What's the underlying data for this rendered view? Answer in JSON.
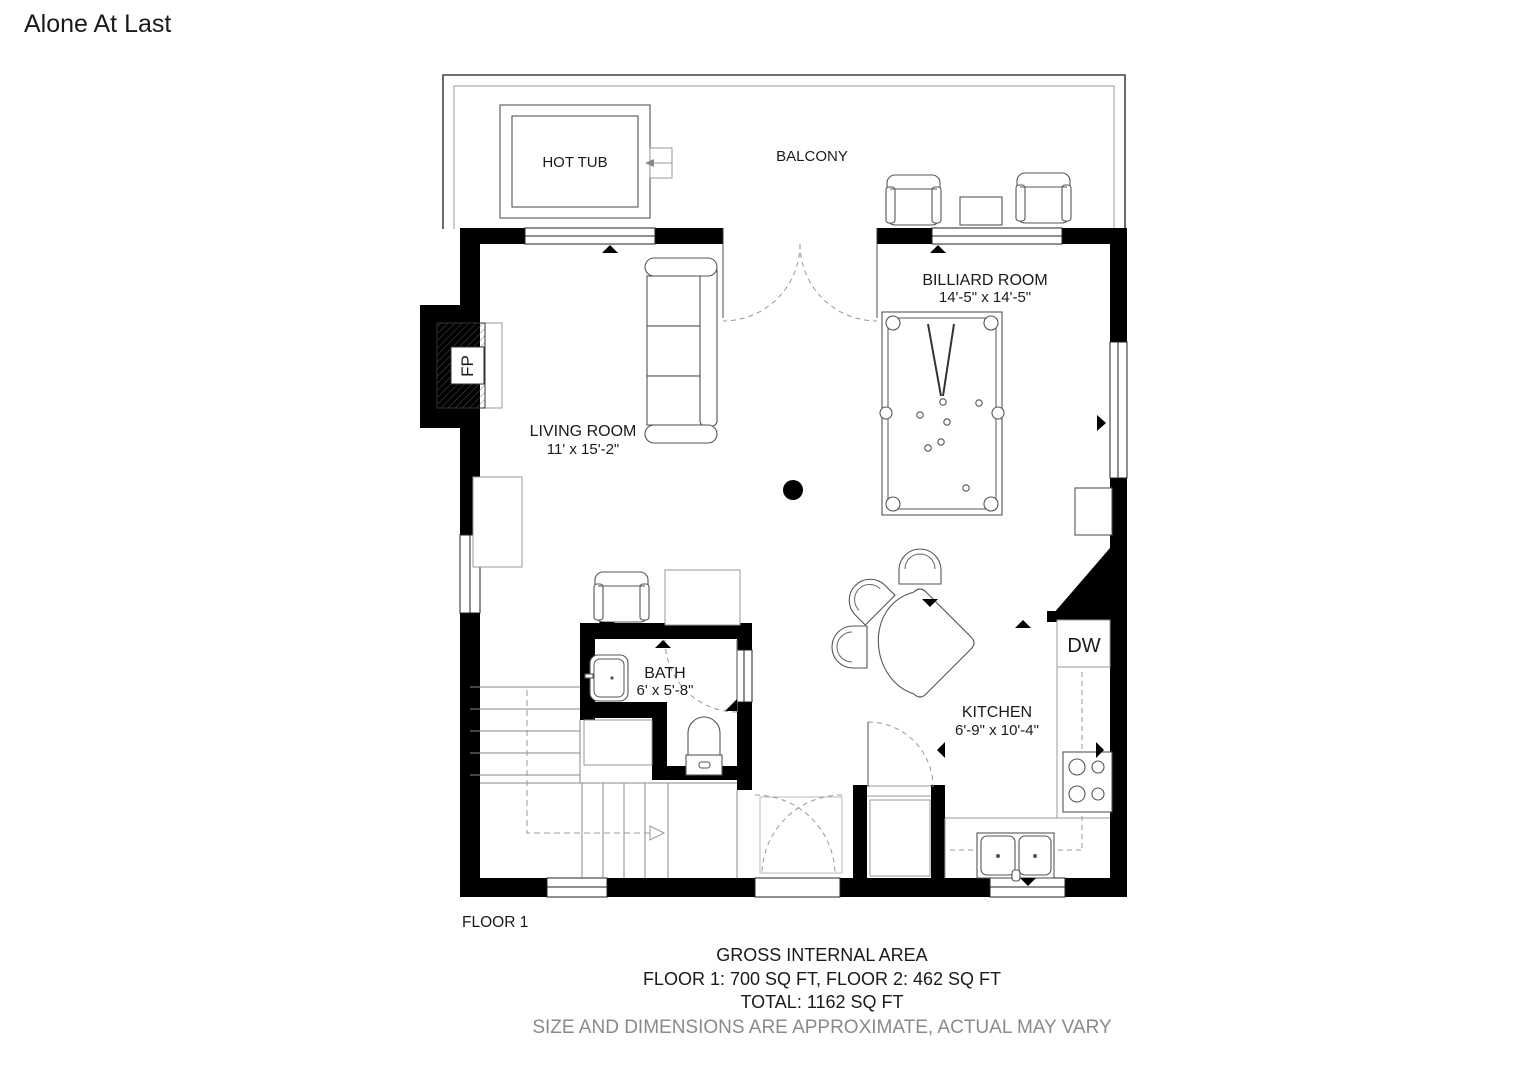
{
  "title": "Alone At Last",
  "floor_label": "FLOOR 1",
  "rooms": {
    "billiard": {
      "name": "BILLIARD ROOM",
      "dims": "14'-5\" x 14'-5\""
    },
    "living": {
      "name": "LIVING ROOM",
      "dims": "11' x 15'-2\""
    },
    "bath": {
      "name": "BATH",
      "dims": "6' x 5'-8\""
    },
    "kitchen": {
      "name": "KITCHEN",
      "dims": "6'-9\" x 10'-4\""
    },
    "balcony": {
      "name": "BALCONY"
    },
    "hot_tub": {
      "name": "HOT TUB"
    }
  },
  "fixtures": {
    "fireplace": "FP",
    "dishwasher": "DW"
  },
  "summary": {
    "heading": "GROSS INTERNAL AREA",
    "line1": "FLOOR 1: 700 SQ FT, FLOOR 2: 462 SQ FT",
    "line2": "TOTAL: 1162 SQ FT",
    "disclaimer": "SIZE AND DIMENSIONS ARE APPROXIMATE, ACTUAL MAY VARY"
  },
  "colors": {
    "wall": "#000000",
    "furniture_line": "#555555",
    "light_line": "#999999",
    "text": "#1a1a1a",
    "muted_text": "#8a8a8a",
    "background": "#ffffff"
  }
}
